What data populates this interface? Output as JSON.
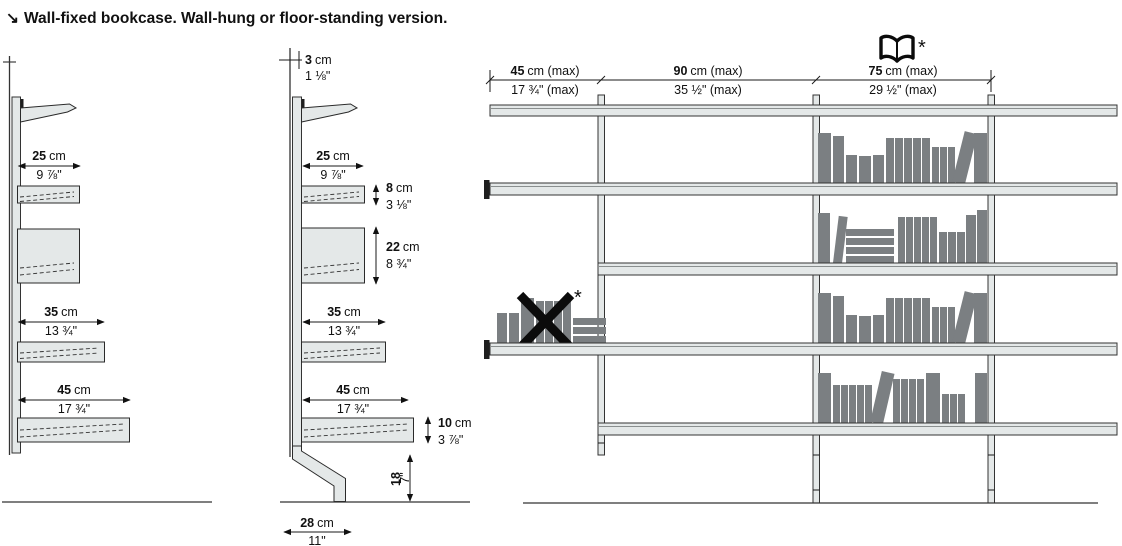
{
  "title": {
    "arrow": "↘",
    "text": "Wall-fixed bookcase. Wall-hung or floor-standing version."
  },
  "wall_hung_view": {
    "depth_25": {
      "cm": "25",
      "cm_suffix": "cm",
      "inch": "9 ⅞\""
    },
    "depth_35": {
      "cm": "35",
      "cm_suffix": "cm",
      "inch": "13 ¾\""
    },
    "depth_45": {
      "cm": "45",
      "cm_suffix": "cm",
      "inch": "17 ¾\""
    }
  },
  "floor_standing_view": {
    "wall_gap_3": {
      "cm": "3",
      "cm_suffix": "cm",
      "inch": "1 ⅛\""
    },
    "depth_25": {
      "cm": "25",
      "cm_suffix": "cm",
      "inch": "9 ⅞\""
    },
    "shelf_height_8": {
      "cm": "8",
      "cm_suffix": "cm",
      "inch": "3 ⅛\""
    },
    "box_height_22": {
      "cm": "22",
      "cm_suffix": "cm",
      "inch": "8 ¾\""
    },
    "depth_35": {
      "cm": "35",
      "cm_suffix": "cm",
      "inch": "13 ¾\""
    },
    "depth_45": {
      "cm": "45",
      "cm_suffix": "cm",
      "inch": "17 ¾\""
    },
    "shelf_height_10": {
      "cm": "10",
      "cm_suffix": "cm",
      "inch": "3 ⅞\""
    },
    "base_height_18": {
      "cm": "18",
      "inch": "7\""
    },
    "base_depth_28": {
      "cm": "28",
      "cm_suffix": "cm",
      "inch": "11\""
    }
  },
  "front_view": {
    "bay_45": {
      "cm": "45",
      "cm_suffix": "cm (max)",
      "inch": "17 ¾\" (max)"
    },
    "bay_90": {
      "cm": "90",
      "cm_suffix": "cm (max)",
      "inch": "35 ½\" (max)"
    },
    "bay_75": {
      "cm": "75",
      "cm_suffix": "cm (max)",
      "inch": "29 ½\" (max)"
    },
    "book_note_asterisk": "*",
    "cross_note_asterisk": "*"
  },
  "colors": {
    "line": "#1a1a1a",
    "text": "#111111",
    "fill_light": "#e4e8e8",
    "books": "#7b7f82"
  }
}
